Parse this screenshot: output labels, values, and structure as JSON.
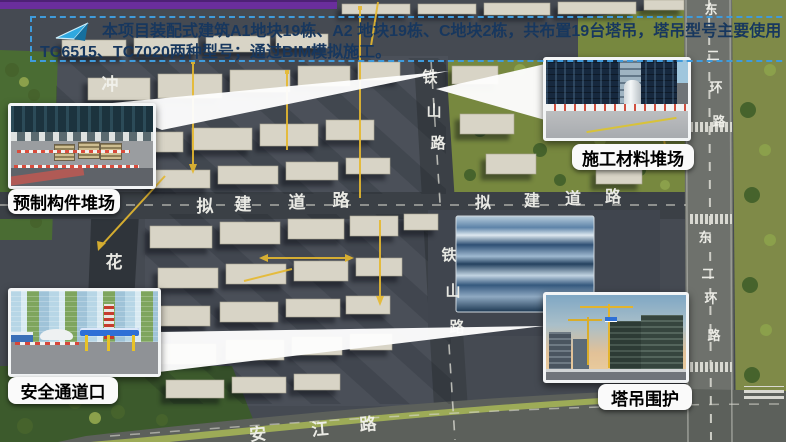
{
  "slide": {
    "top_bar_color": "#6a2e9c",
    "banner": {
      "icon": "paper-plane-arrow-icon",
      "line1": "本项目装配式建筑A1地块19栋、A2 地块19栋、C地块2栋，共布置19台塔吊，塔吊型号主要使用",
      "line2": "TC6515、TC7020两种型号；通过BIM模拟施工。",
      "text_color": "#17375e",
      "border_color": "#3f9bdc"
    }
  },
  "callouts": [
    {
      "label": "预制构件堆场"
    },
    {
      "label": "施工材料堆场"
    },
    {
      "label": "安全通道口"
    },
    {
      "label": "塔吊围护"
    }
  ],
  "map": {
    "accent_yellow": "#e6b92f",
    "roads": {
      "planned_west": [
        "拟",
        "建",
        "道",
        "路"
      ],
      "planned_east": [
        "拟",
        "建",
        "道",
        "路"
      ],
      "tieshan_north": [
        "铁",
        "山",
        "路"
      ],
      "tieshan_south": [
        "铁",
        "山",
        "路"
      ],
      "ring_north": [
        "东",
        "二",
        "环",
        "路"
      ],
      "ring_south": [
        "东",
        "二",
        "环",
        "路"
      ],
      "anjiang": [
        "安",
        "江",
        "路"
      ],
      "hua": "花",
      "chong": "冲"
    }
  }
}
